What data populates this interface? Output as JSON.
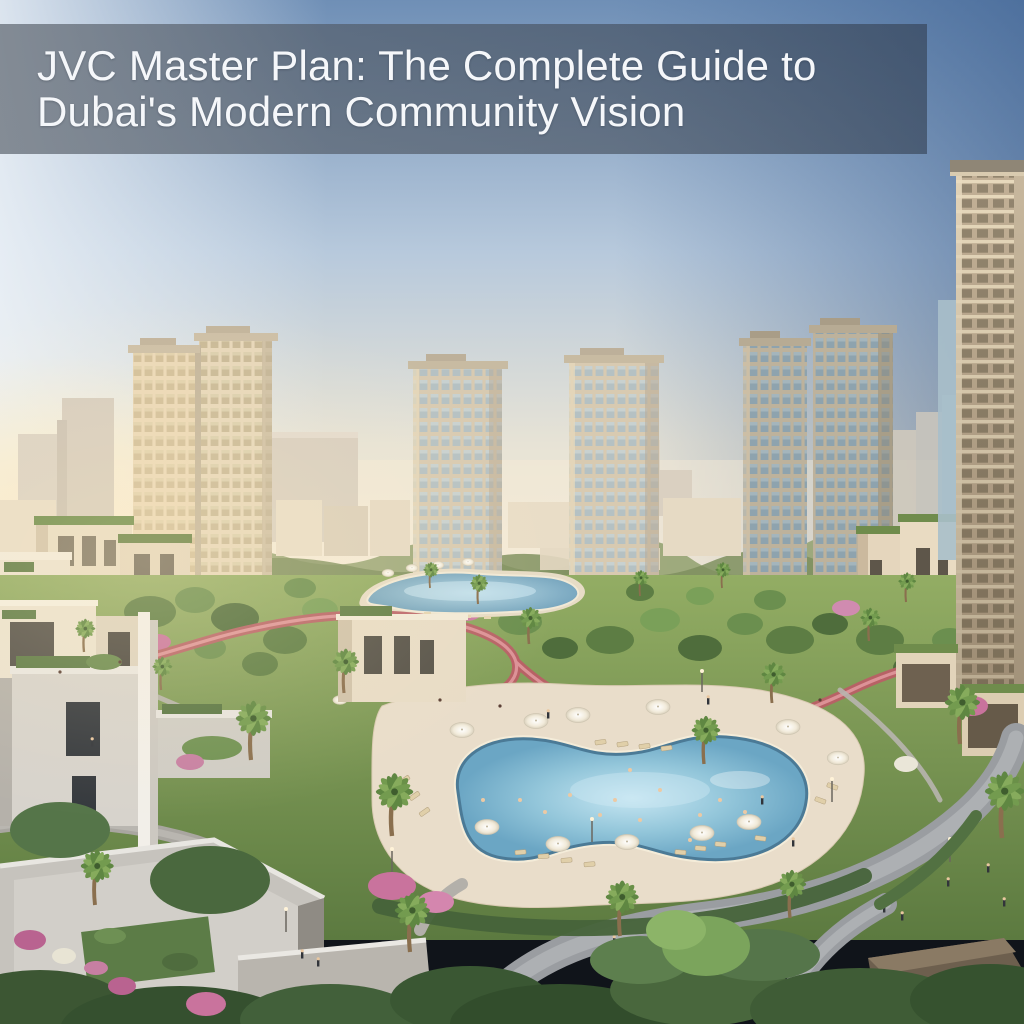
{
  "banner": {
    "line1": "JVC Master Plan: The Complete Guide to",
    "line2": "Dubai's Modern Community Vision",
    "text_color": "#f5f7fa",
    "background_rgba": "rgba(47,58,74,0.58)"
  },
  "palette": {
    "sky_top_right": "#44699b",
    "sky_light": "#dbe4ee",
    "horizon_glow": "#fbeed6",
    "tower_beige": "#d8cab1",
    "tower_glass": "#b5c1c3",
    "tower_glass_cool": "#8ea3ae",
    "park_green": "#7d9c55",
    "track_pink": "#b95f66",
    "pool_water": "#7fb8d4",
    "deck_sand": "#e9ddca",
    "path_gray": "#a7a49e",
    "foreground_building_gray": "#d2cfc9",
    "bougainvillea_pink": "#c9739d"
  },
  "scene": {
    "elements": [
      {
        "name": "sky-gradient"
      },
      {
        "name": "distant-city-skyline"
      },
      {
        "name": "residential-towers",
        "count": 6
      },
      {
        "name": "low-rise-villas"
      },
      {
        "name": "community-park"
      },
      {
        "name": "running-track"
      },
      {
        "name": "lagoon-pool"
      },
      {
        "name": "main-swimming-pool"
      },
      {
        "name": "pool-umbrellas"
      },
      {
        "name": "sun-loungers"
      },
      {
        "name": "palm-trees"
      },
      {
        "name": "walking-paths"
      },
      {
        "name": "pedestrians"
      },
      {
        "name": "foreground-buildings-roof-gardens"
      }
    ]
  }
}
